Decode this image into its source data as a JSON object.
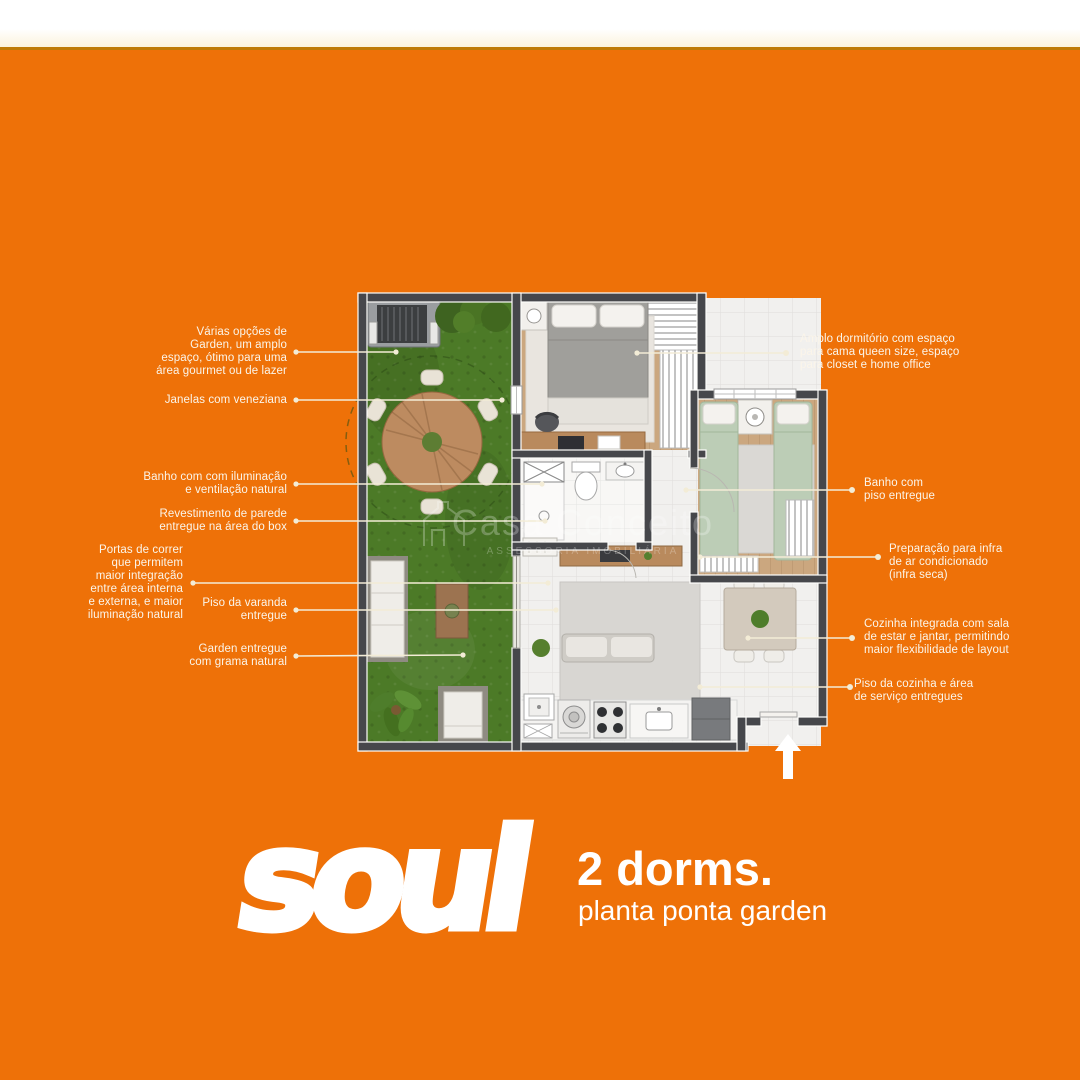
{
  "colors": {
    "background": "#EE7108",
    "top_strip": "#FFFFFF",
    "accent_line": "#BE7A06",
    "annotation_text": "#FBF5EA",
    "leader_line": "#F3ECD6",
    "wall": "#46474B",
    "grass": "#4C7A27"
  },
  "annotations": {
    "left": [
      {
        "id": "garden-options",
        "lines": [
          "Várias opções de",
          "Garden, um amplo",
          "espaço, ótimo para uma",
          "área gourmet ou de lazer"
        ]
      },
      {
        "id": "janelas",
        "lines": [
          "Janelas com veneziana"
        ]
      },
      {
        "id": "banho-iluminacao",
        "lines": [
          "Banho com com iluminação",
          "e ventilação natural"
        ]
      },
      {
        "id": "revestimento",
        "lines": [
          "Revestimento de parede",
          "entregue na área do box"
        ]
      },
      {
        "id": "portas-correr",
        "lines": [
          "Portas de correr",
          "que permitem",
          "maior integração",
          "entre área interna",
          "e externa, e maior",
          "iluminação natural"
        ]
      },
      {
        "id": "piso-varanda",
        "lines": [
          "Piso da varanda",
          "entregue"
        ]
      },
      {
        "id": "garden-grama",
        "lines": [
          "Garden entregue",
          "com grama natural"
        ]
      }
    ],
    "right": [
      {
        "id": "amplo-dormitorio",
        "lines": [
          "Amplo dormitório com espaço",
          "para cama queen size, espaço",
          "para closet e home office"
        ]
      },
      {
        "id": "banho-piso",
        "lines": [
          "Banho com",
          "piso entregue"
        ]
      },
      {
        "id": "infra-ar",
        "lines": [
          "Preparação para infra",
          "de ar condicionado",
          "(infra seca)"
        ]
      },
      {
        "id": "cozinha-integrada",
        "lines": [
          "Cozinha integrada com sala",
          "de estar e jantar, permitindo",
          "maior flexibilidade de layout"
        ]
      },
      {
        "id": "piso-cozinha",
        "lines": [
          "Piso da cozinha e área",
          "de serviço entregues"
        ]
      }
    ]
  },
  "watermark": {
    "title": "Casa Conceito",
    "subtitle": "ASSESSORIA IMOBILIÁRIA"
  },
  "footer": {
    "logo_text": "soul",
    "dorms": "2 dorms.",
    "plan_name": "planta ponta garden"
  }
}
